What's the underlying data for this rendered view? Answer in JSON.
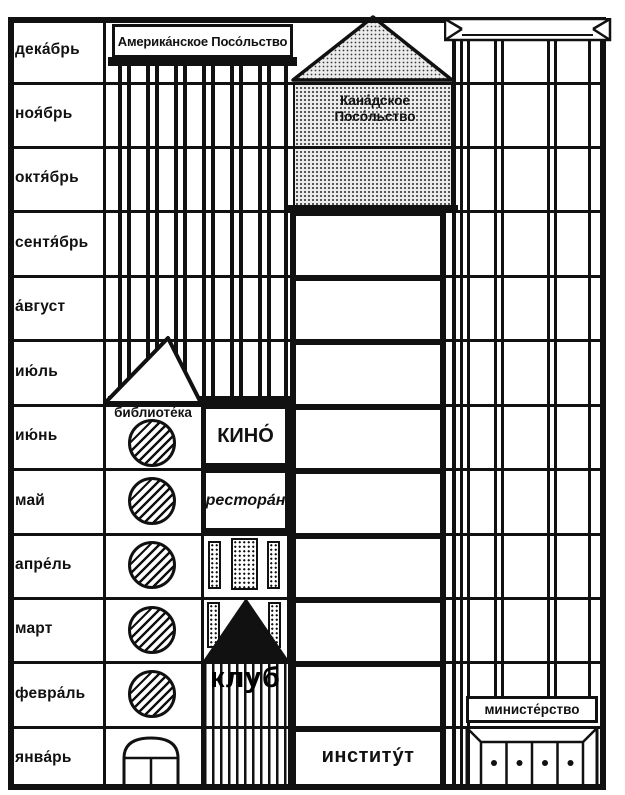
{
  "title": "Months and buildings picture puzzle (Russian)",
  "months": [
    "дека́брь",
    "ноя́брь",
    "октя́брь",
    "сентя́брь",
    "а́вгуст",
    "ию́ль",
    "ию́нь",
    "май",
    "апре́ль",
    "март",
    "февра́ль",
    "янва́рь"
  ],
  "buildings": {
    "american_embassy": {
      "label": "Америка́нское Посо́льство"
    },
    "canadian_embassy": {
      "label_line1": "Кана́дское",
      "label_line2": "Посо́льство"
    },
    "library": {
      "label": "библиоте́ка"
    },
    "cinema": {
      "label": "КИНО́"
    },
    "restaurant": {
      "label": "рестора́н"
    },
    "club": {
      "label": "клуб"
    },
    "institute": {
      "label": "институ́т"
    },
    "ministry": {
      "label": "министе́рство"
    }
  },
  "colors": {
    "ink": "#111111",
    "paper": "#ffffff",
    "halftone": "#ececec"
  }
}
